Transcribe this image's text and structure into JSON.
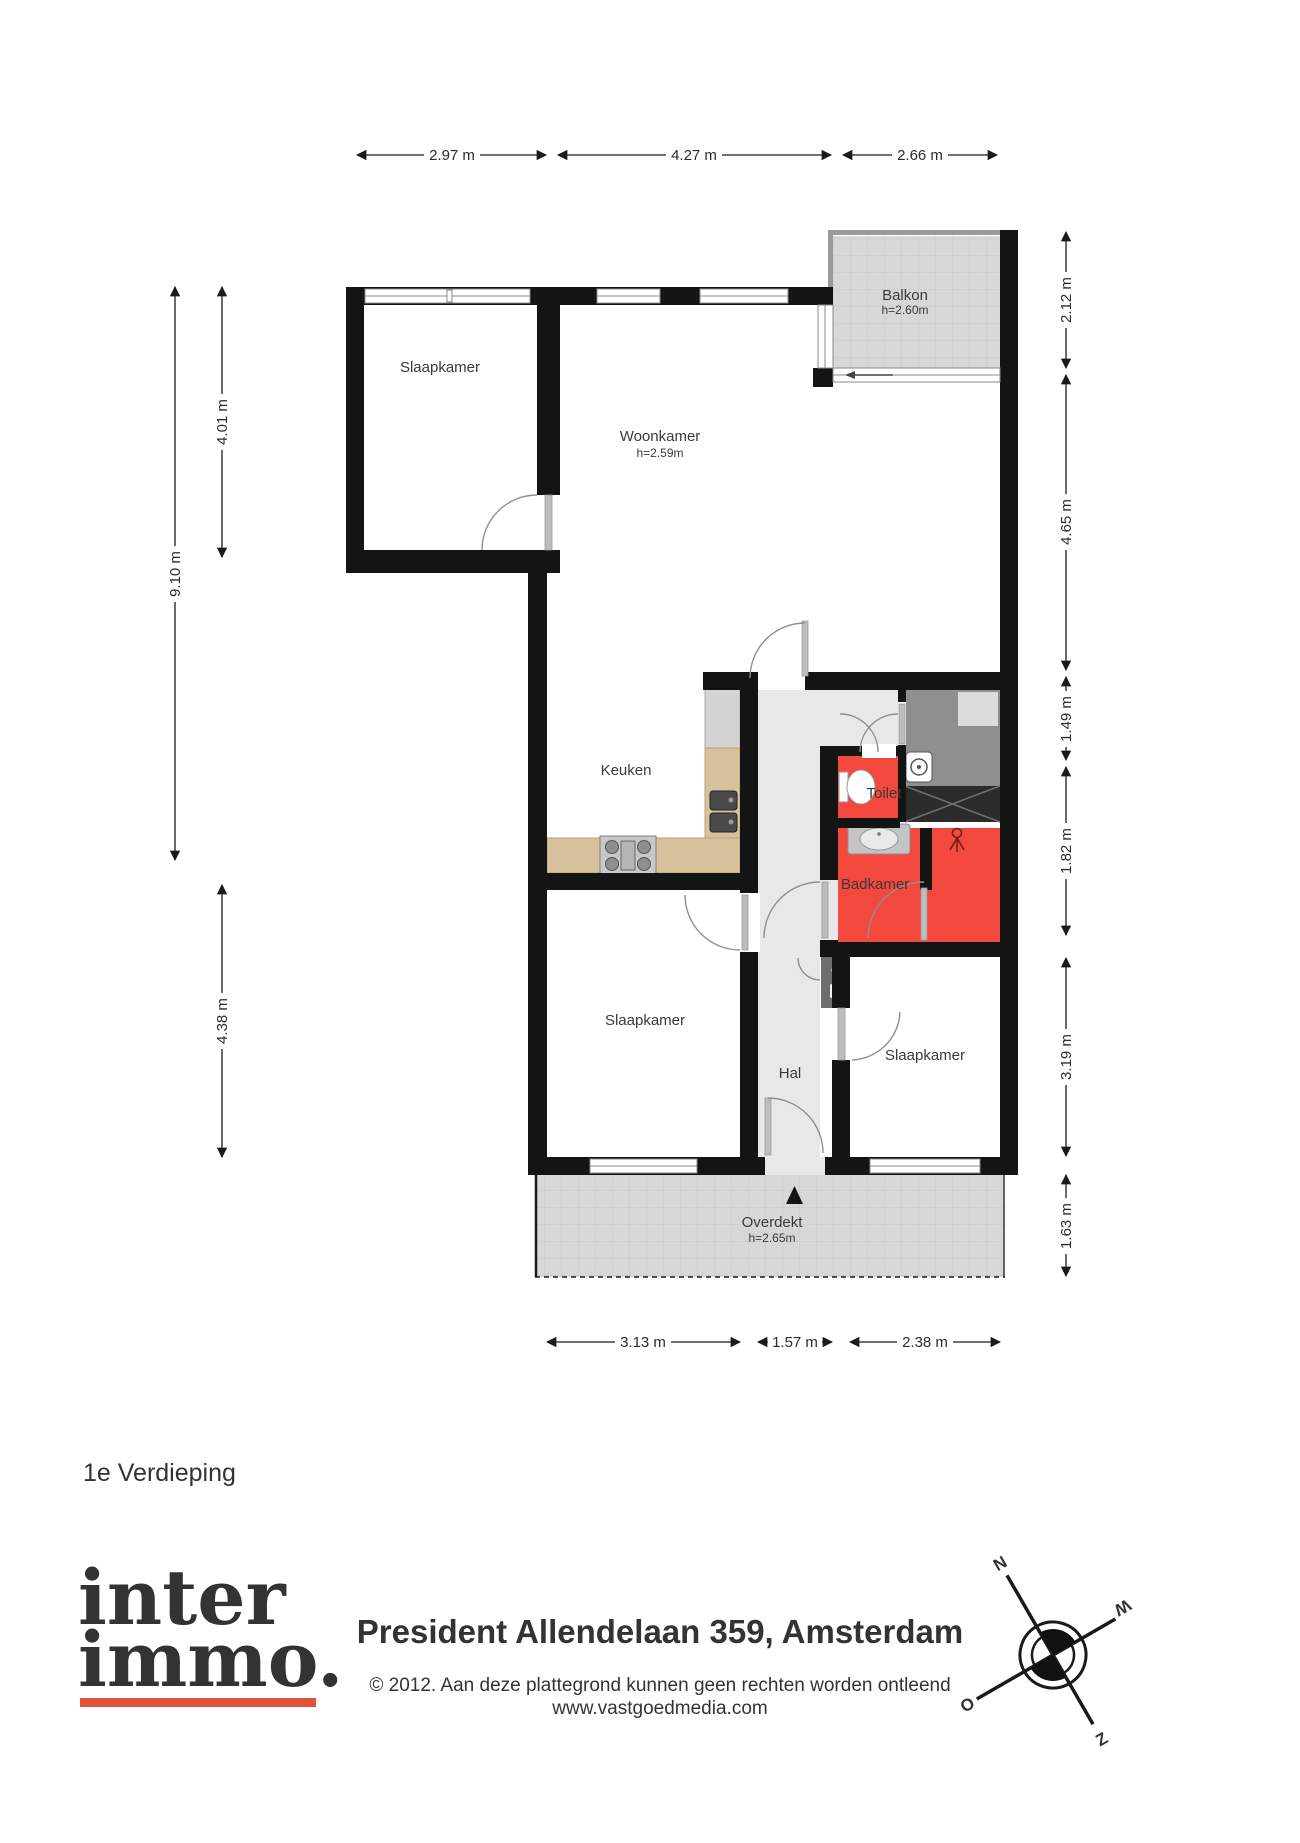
{
  "floor_label": "1e Verdieping",
  "footer": {
    "title": "President Allendelaan 359, Amsterdam",
    "copyright": "© 2012. Aan deze plattegrond kunnen geen rechten worden ontleend",
    "website": "www.vastgoedmedia.com"
  },
  "logo": {
    "line1": "inter",
    "line2": "immo.",
    "color": "#e0523e"
  },
  "compass": {
    "north": "N",
    "east": "O",
    "south": "Z",
    "west": "W"
  },
  "rooms": {
    "balkon": {
      "name": "Balkon",
      "height": "h=2.60m"
    },
    "woonkamer": {
      "name": "Woonkamer",
      "height": "h=2.59m"
    },
    "slaapkamer_top": {
      "name": "Slaapkamer"
    },
    "keuken": {
      "name": "Keuken"
    },
    "toilet": {
      "name": "Toilet"
    },
    "badkamer": {
      "name": "Badkamer"
    },
    "hal": {
      "name": "Hal"
    },
    "slaapkamer_links": {
      "name": "Slaapkamer"
    },
    "slaapkamer_rechts": {
      "name": "Slaapkamer"
    },
    "overdekt": {
      "name": "Overdekt",
      "height": "h=2.65m"
    }
  },
  "dimensions": {
    "top": [
      "2.97 m",
      "4.27 m",
      "2.66 m"
    ],
    "right": [
      "2.12 m",
      "4.65 m",
      "1.49 m",
      "1.82 m",
      "3.19 m",
      "1.63 m"
    ],
    "left": [
      "4.01 m",
      "9.10 m",
      "4.38 m"
    ],
    "bottom": [
      "3.13 m",
      "1.57 m",
      "2.38 m"
    ]
  },
  "colors": {
    "wall": "#141414",
    "wet_room": "#f2483d",
    "hall_floor": "#e8e8e8",
    "closet": "#8f8f8f",
    "counter": "#d6c19b",
    "outdoor": "#d7d7d7",
    "logo_red": "#e0523e"
  }
}
